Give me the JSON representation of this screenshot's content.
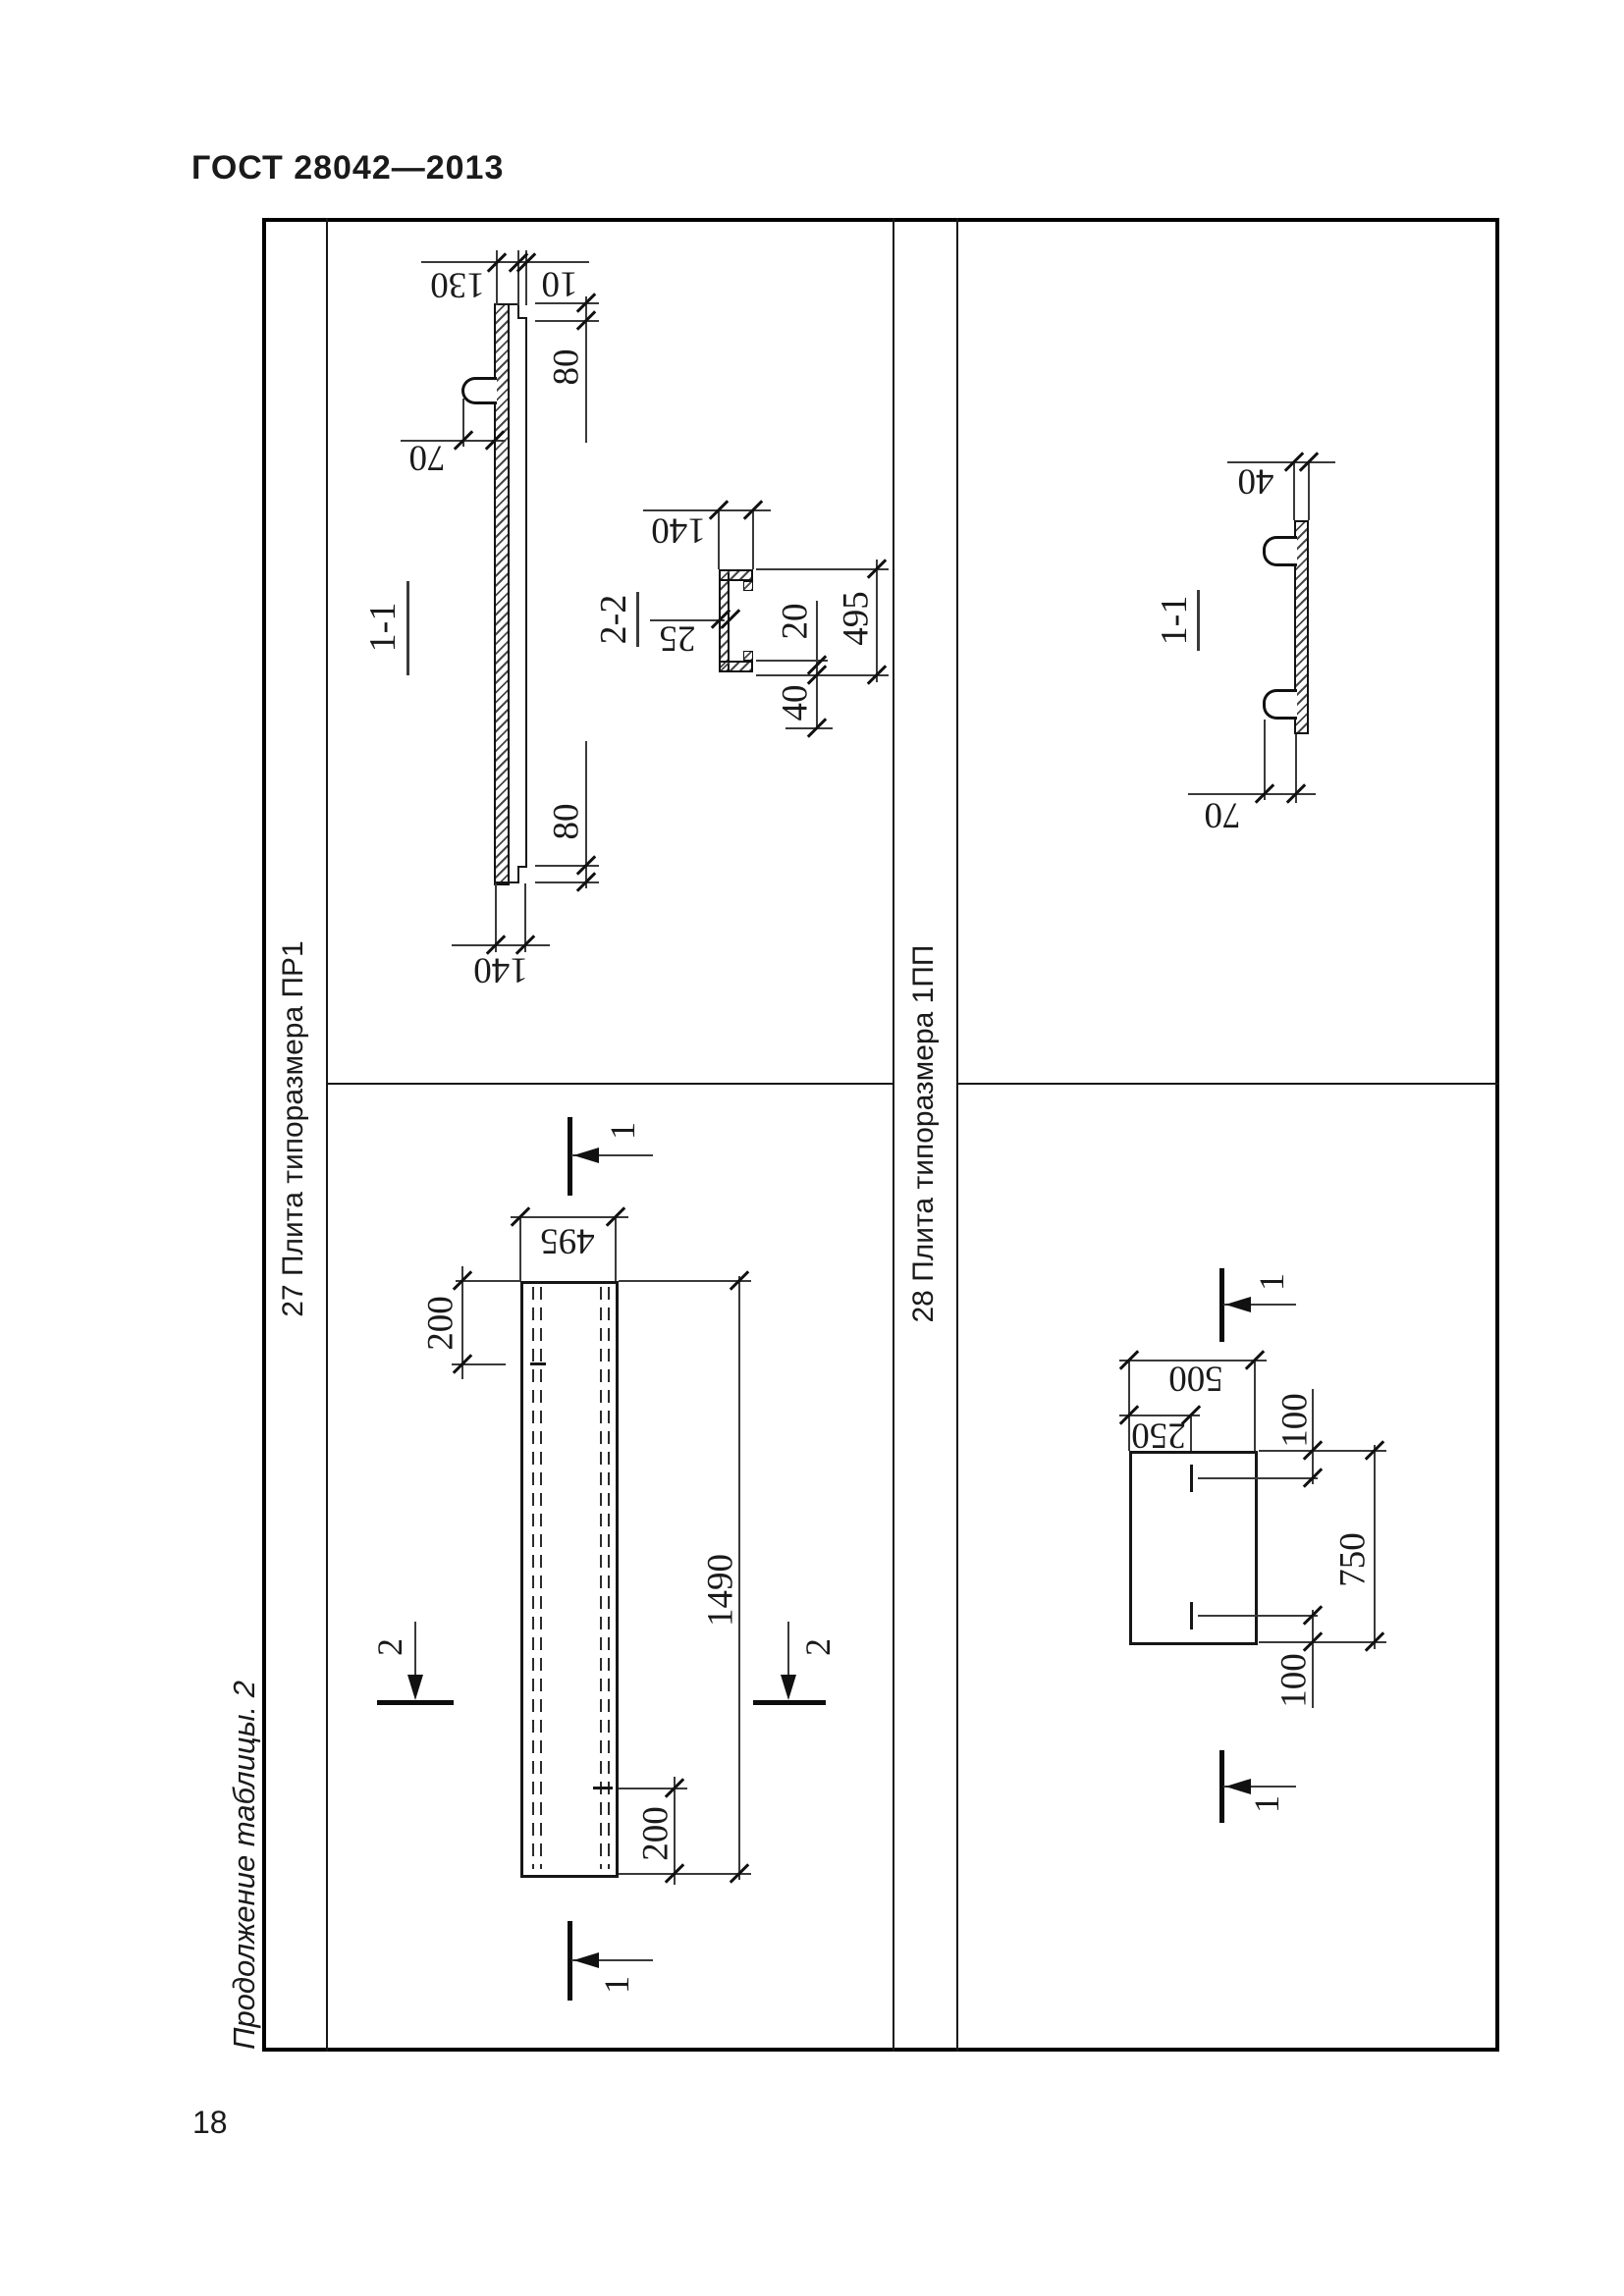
{
  "page": {
    "header": "ГОСТ 28042—2013",
    "page_number": "18",
    "table_note": "Продолжение таблицы. 2",
    "colors": {
      "paper": "#ffffff",
      "ink": "#161616"
    }
  },
  "row27": {
    "label": "27 Плита типоразмера ПР1",
    "section11": {
      "title": "1-1",
      "dim_130": "130",
      "dim_10": "10",
      "dim_80_top": "80",
      "dim_70": "70",
      "dim_80_bottom": "80",
      "dim_140_bottom": "140"
    },
    "section22": {
      "title": "2-2",
      "dim_140": "140",
      "dim_25": "25",
      "dim_495": "495",
      "dim_20": "20",
      "dim_40": "40"
    },
    "plan": {
      "dim_495": "495",
      "dim_200_top": "200",
      "dim_1490": "1490",
      "dim_200_bottom": "200",
      "marker_1": "1",
      "marker_2": "2"
    }
  },
  "row28": {
    "label": "28 Плита типоразмера 1ПП",
    "section11": {
      "title": "1-1",
      "dim_40": "40",
      "dim_70": "70"
    },
    "plan": {
      "dim_500": "500",
      "dim_250": "250",
      "dim_100_top": "100",
      "dim_750": "750",
      "dim_100_bottom": "100",
      "marker_1": "1"
    }
  }
}
